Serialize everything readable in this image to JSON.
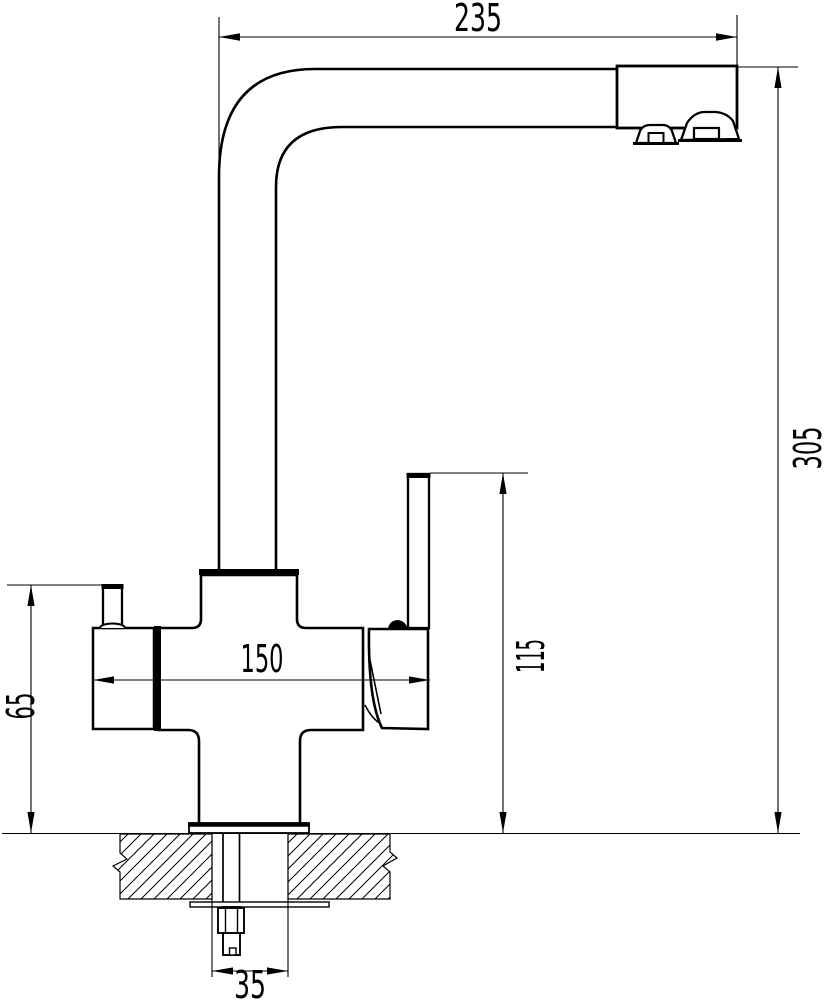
{
  "drawing": {
    "name": "kitchen-faucet-two-handle-technical-drawing",
    "background_color": "#ffffff",
    "line_color": "#000000",
    "dimensions": {
      "spout_reach": "235",
      "overall_height": "305",
      "body_width": "150",
      "lever_height": "115",
      "side_handle_height": "65",
      "mounting_hole": "35"
    }
  }
}
